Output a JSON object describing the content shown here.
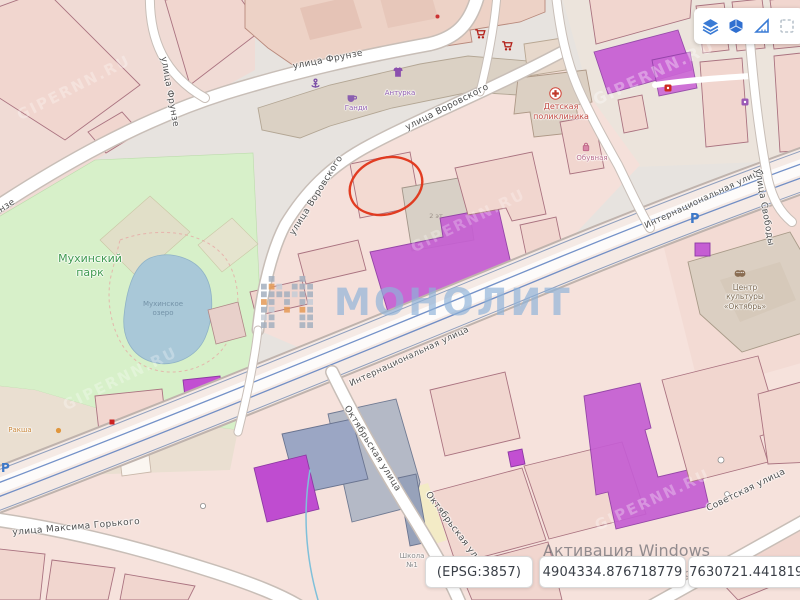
{
  "ui": {
    "toolbar": {
      "buttons": [
        {
          "name": "layers"
        },
        {
          "name": "3d-buildings"
        },
        {
          "name": "measure"
        },
        {
          "name": "select-area"
        }
      ]
    },
    "statusbar": {
      "epsg": "(EPSG:3857)",
      "coord_x": "4904334.876718779",
      "coord_y": "7630721.441819922"
    },
    "windows_activation": {
      "title": "Активация Windows",
      "subtitle": "Чтобы активировать Windows, перейдите в раздел \"Параметры\"."
    }
  },
  "watermarks": {
    "brand": "МОНОЛИТ",
    "site": "GIPERNN.RU"
  },
  "labels": {
    "streets": [
      {
        "text": "улица Фрунзе"
      },
      {
        "text": "улица Фрунзе"
      },
      {
        "text": "улица Фрунзе"
      },
      {
        "text": "улица Воровского"
      },
      {
        "text": "улица Воровского"
      },
      {
        "text": "Интернациональная улица"
      },
      {
        "text": "Интернациональная улица"
      },
      {
        "text": "улица Свободы"
      },
      {
        "text": "Октябрьская улица"
      },
      {
        "text": "Октябрьская улица"
      },
      {
        "text": "улица Максима Горького"
      },
      {
        "text": "Советская улица"
      }
    ],
    "places": [
      {
        "text": "Мухинский\nпарк"
      },
      {
        "text": "Мухинское\nозеро"
      },
      {
        "text": "Детская\nполиклиника"
      },
      {
        "text": "Обувная"
      },
      {
        "text": "Центр\nкультуры\n«Октябрь»"
      },
      {
        "text": "Школа\n№1"
      },
      {
        "text": "Ракша"
      },
      {
        "text": "2 эт"
      },
      {
        "text": "Ганди"
      },
      {
        "text": "Антурка"
      }
    ],
    "symbols": {
      "parking": "P"
    }
  }
}
